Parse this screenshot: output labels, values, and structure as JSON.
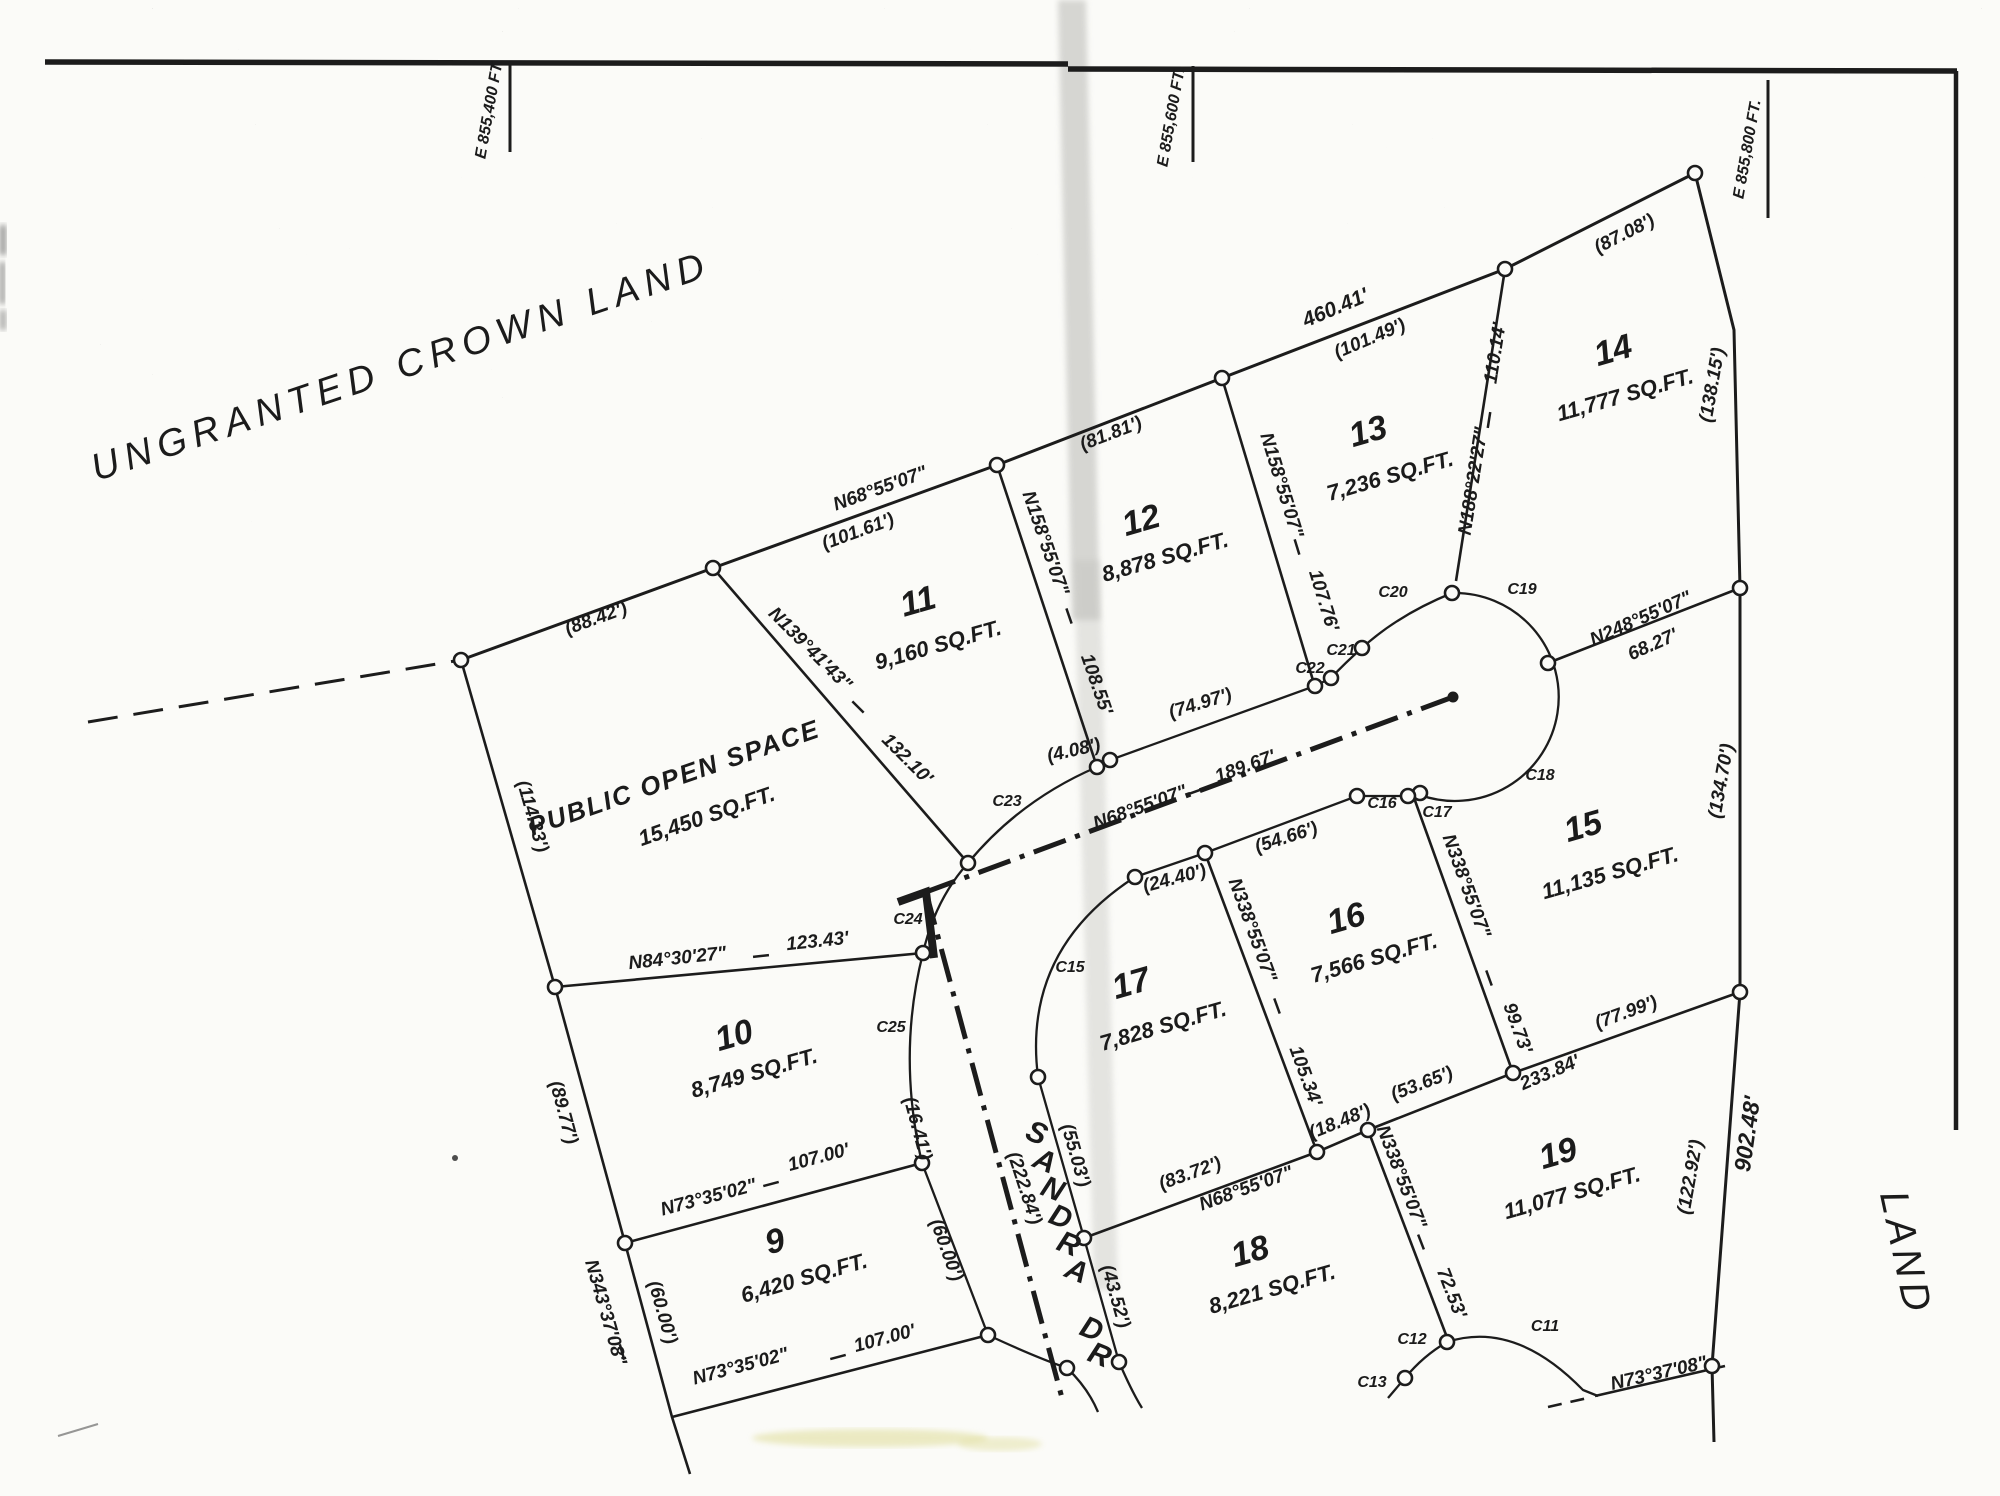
{
  "sheet": {
    "crown_label": "UNGRANTED CROWN LAND",
    "edge_label": "LAND",
    "street_name": "SANDRA DR"
  },
  "grid_ticks": {
    "t1": "E 855,400 FT.",
    "t2": "E 855,600 FT.",
    "t3": "E 855,800 FT."
  },
  "open_space": {
    "name": "PUBLIC OPEN SPACE",
    "area": "15,450 SQ.FT."
  },
  "lots": {
    "9": {
      "num": "9",
      "area": "6,420 SQ.FT."
    },
    "10": {
      "num": "10",
      "area": "8,749 SQ.FT."
    },
    "11": {
      "num": "11",
      "area": "9,160 SQ.FT."
    },
    "12": {
      "num": "12",
      "area": "8,878 SQ.FT."
    },
    "13": {
      "num": "13",
      "area": "7,236 SQ.FT."
    },
    "14": {
      "num": "14",
      "area": "11,777 SQ.FT."
    },
    "15": {
      "num": "15",
      "area": "11,135 SQ.FT."
    },
    "16": {
      "num": "16",
      "area": "7,566 SQ.FT."
    },
    "17": {
      "num": "17",
      "area": "7,828 SQ.FT."
    },
    "18": {
      "num": "18",
      "area": "8,221 SQ.FT."
    },
    "19": {
      "num": "19",
      "area": "11,077 SQ.FT."
    }
  },
  "dims": {
    "d88_42": "(88.42')",
    "n68_55_07": "N68°55'07\"",
    "d101_61": "(101.61')",
    "d81_81": "(81.81')",
    "d460_41": "460.41'",
    "d101_49": "(101.49')",
    "d87_08": "(87.08')",
    "d138_15": "(138.15')",
    "n139_41_43": "N139°41'43\"",
    "d132_10": "132.10'",
    "n158_55_07": "N158°55'07\"",
    "d108_55": "108.55'",
    "d107_76": "107.76'",
    "n188_22_27": "N188°22'27\"",
    "d110_14": "110.14'",
    "n248_55_07": "N248°55'07\"",
    "d68_27": "68.27'",
    "d134_70": "(134.70')",
    "d74_97": "(74.97')",
    "d4_08": "(4.08')",
    "d189_67": "189.67'",
    "n84_30_27": "N84°30'27\"",
    "d123_43": "123.43'",
    "d89_77": "(89.77')",
    "n73_35_02": "N73°35'02\"",
    "d107_00": "107.00'",
    "d16_41": "(16.41')",
    "n343_37_08": "N343°37'08\"",
    "d60_00": "(60.00')",
    "d222_84": "(222.84')",
    "d55_03": "(55.03')",
    "d43_52": "(43.52')",
    "d24_40": "(24.40')",
    "d54_66": "(54.66')",
    "n338_55_07": "N338°55'07\"",
    "d105_34": "105.34'",
    "d99_73": "99.73'",
    "d72_53": "72.53'",
    "d83_72": "(83.72')",
    "d18_48": "(18.48')",
    "d53_65": "(53.65')",
    "d77_99": "(77.99')",
    "d233_84": "233.84'",
    "n73_37_08": "N73°37'08\"",
    "d122_92": "(122.92')",
    "d902_48": "902.48'",
    "d114_33": "(114.33')"
  },
  "curves": {
    "c11": "C11",
    "c12": "C12",
    "c13": "C13",
    "c15": "C15",
    "c16": "C16",
    "c17": "C17",
    "c18": "C18",
    "c19": "C19",
    "c20": "C20",
    "c21": "C21",
    "c22": "C22",
    "c23": "C23",
    "c24": "C24",
    "c25": "C25"
  }
}
